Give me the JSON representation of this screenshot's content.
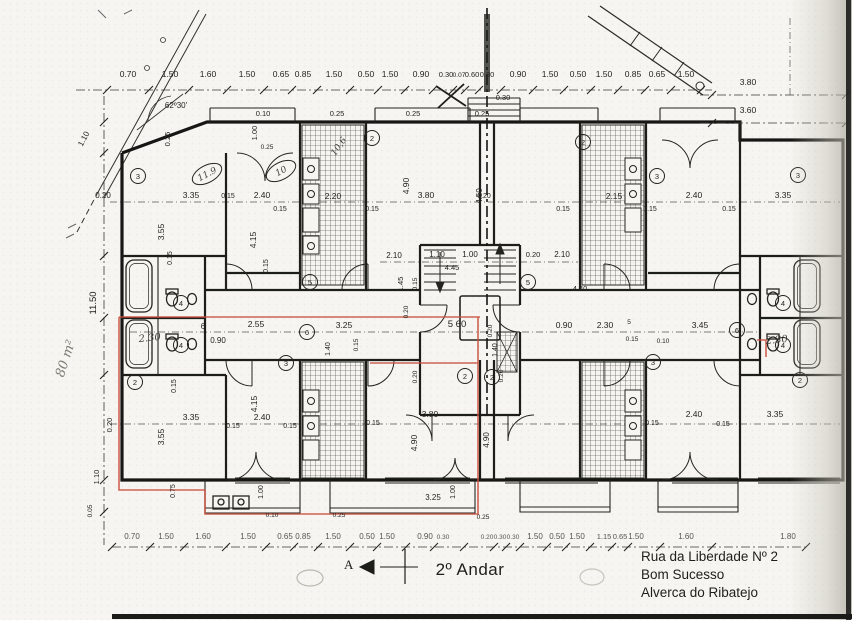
{
  "meta": {
    "title": "2º Andar"
  },
  "address": {
    "line1": "Rua da Liberdade Nº 2",
    "line2": "Bom Sucesso",
    "line3": "Alverca do Ribatejo"
  },
  "annotations": {
    "area_note": "80 m²",
    "section_letter": "A"
  },
  "colors": {
    "ink": "#24241f",
    "wall": "#161614",
    "highlight": "#c94f3d",
    "pencil": "#7b7b72",
    "paper": "#f6f5f1"
  },
  "plan": {
    "labels": [
      {
        "t": "0.70",
        "x": 128,
        "y": 77
      },
      {
        "t": "1.50",
        "x": 170,
        "y": 77
      },
      {
        "t": "1.60",
        "x": 208,
        "y": 77
      },
      {
        "t": "1.50",
        "x": 247,
        "y": 77
      },
      {
        "t": "0.65",
        "x": 281,
        "y": 77
      },
      {
        "t": "0.85",
        "x": 303,
        "y": 77
      },
      {
        "t": "1.50",
        "x": 334,
        "y": 77
      },
      {
        "t": "0.50",
        "x": 366,
        "y": 77
      },
      {
        "t": "1.50",
        "x": 390,
        "y": 77
      },
      {
        "t": "0.90",
        "x": 421,
        "y": 77
      },
      {
        "t": "0.30",
        "x": 446,
        "y": 77,
        "s": 7.5
      },
      {
        "t": "0.07",
        "x": 459,
        "y": 77,
        "s": 6.5
      },
      {
        "t": "0.60",
        "x": 472,
        "y": 77,
        "s": 7.5
      },
      {
        "t": "0.30",
        "x": 487,
        "y": 77,
        "s": 7.5
      },
      {
        "t": "0.90",
        "x": 518,
        "y": 77
      },
      {
        "t": "1.50",
        "x": 550,
        "y": 77
      },
      {
        "t": "0.50",
        "x": 578,
        "y": 77
      },
      {
        "t": "1.50",
        "x": 604,
        "y": 77
      },
      {
        "t": "0.85",
        "x": 633,
        "y": 77
      },
      {
        "t": "0.65",
        "x": 657,
        "y": 77
      },
      {
        "t": "1.50",
        "x": 686,
        "y": 77
      },
      {
        "t": "0.30",
        "x": 503,
        "y": 100,
        "s": 7.5
      },
      {
        "t": "3.80",
        "x": 748,
        "y": 85
      },
      {
        "t": "3.60",
        "x": 748,
        "y": 113
      },
      {
        "t": "0.70",
        "x": 132,
        "y": 539,
        "k": "dim2",
        "s": 8
      },
      {
        "t": "1.50",
        "x": 166,
        "y": 539,
        "k": "dim2",
        "s": 8
      },
      {
        "t": "1.60",
        "x": 203,
        "y": 539,
        "k": "dim2",
        "s": 8
      },
      {
        "t": "1.50",
        "x": 248,
        "y": 539,
        "k": "dim2",
        "s": 8
      },
      {
        "t": "0.65",
        "x": 285,
        "y": 539,
        "k": "dim2",
        "s": 8
      },
      {
        "t": "0.85",
        "x": 303,
        "y": 539,
        "k": "dim2",
        "s": 8
      },
      {
        "t": "1.50",
        "x": 333,
        "y": 539,
        "k": "dim2",
        "s": 8
      },
      {
        "t": "0.50",
        "x": 367,
        "y": 539,
        "k": "dim2",
        "s": 8
      },
      {
        "t": "1.50",
        "x": 387,
        "y": 539,
        "k": "dim2",
        "s": 8
      },
      {
        "t": "0.90",
        "x": 425,
        "y": 539,
        "k": "dim2",
        "s": 8
      },
      {
        "t": "0.30",
        "x": 443,
        "y": 539,
        "k": "dim2",
        "s": 6.5
      },
      {
        "t": "0.20",
        "x": 487,
        "y": 539,
        "k": "dim2",
        "s": 6.5
      },
      {
        "t": "0.30",
        "x": 500,
        "y": 539,
        "k": "dim2",
        "s": 6.5
      },
      {
        "t": "0.30",
        "x": 513,
        "y": 539,
        "k": "dim2",
        "s": 6.5
      },
      {
        "t": "1.50",
        "x": 535,
        "y": 539,
        "k": "dim2",
        "s": 8
      },
      {
        "t": "0.50",
        "x": 557,
        "y": 539,
        "k": "dim2",
        "s": 8
      },
      {
        "t": "1.50",
        "x": 577,
        "y": 539,
        "k": "dim2",
        "s": 8
      },
      {
        "t": "1.15",
        "x": 604,
        "y": 539,
        "k": "dim2",
        "s": 7.5
      },
      {
        "t": "0.65",
        "x": 620,
        "y": 539,
        "k": "dim2",
        "s": 7.5
      },
      {
        "t": "1.50",
        "x": 636,
        "y": 539,
        "k": "dim2",
        "s": 8
      },
      {
        "t": "1.60",
        "x": 686,
        "y": 539,
        "k": "dim2",
        "s": 8
      },
      {
        "t": "1.80",
        "x": 788,
        "y": 539,
        "k": "dim2",
        "s": 8
      },
      {
        "t": "1.10",
        "x": 86,
        "y": 140,
        "r": -62,
        "s": 8
      },
      {
        "t": "11.50",
        "x": 96,
        "y": 303,
        "r": -90,
        "s": 9.5
      },
      {
        "t": "1.10",
        "x": 99,
        "y": 477,
        "r": -90,
        "s": 7.5
      },
      {
        "t": "0.05",
        "x": 92,
        "y": 511,
        "r": -90,
        "s": 6.5
      },
      {
        "t": "0.20",
        "x": 103,
        "y": 198,
        "s": 8
      },
      {
        "t": "3.35",
        "x": 191,
        "y": 198
      },
      {
        "t": "0.15",
        "x": 228,
        "y": 198,
        "s": 7
      },
      {
        "t": "2.40",
        "x": 262,
        "y": 198
      },
      {
        "t": "0.15",
        "x": 280,
        "y": 211,
        "s": 7
      },
      {
        "t": "2.20",
        "x": 333,
        "y": 199
      },
      {
        "t": "0.15",
        "x": 372,
        "y": 211,
        "s": 7
      },
      {
        "t": "3.80",
        "x": 426,
        "y": 198
      },
      {
        "t": "0.20",
        "x": 484,
        "y": 198,
        "s": 7
      },
      {
        "t": "0.15",
        "x": 563,
        "y": 211,
        "s": 7
      },
      {
        "t": "2.15",
        "x": 614,
        "y": 199
      },
      {
        "t": "0.15",
        "x": 650,
        "y": 211,
        "s": 7
      },
      {
        "t": "2.40",
        "x": 694,
        "y": 198
      },
      {
        "t": "0.15",
        "x": 729,
        "y": 211,
        "s": 7
      },
      {
        "t": "3.35",
        "x": 783,
        "y": 198
      },
      {
        "t": "3.55",
        "x": 164,
        "y": 232,
        "r": -90
      },
      {
        "t": "4.15",
        "x": 256,
        "y": 240,
        "r": -90
      },
      {
        "t": "4.90",
        "x": 409,
        "y": 186,
        "r": -90
      },
      {
        "t": "4.50",
        "x": 482,
        "y": 196,
        "r": -90,
        "s": 8
      },
      {
        "t": "0.15",
        "x": 172,
        "y": 258,
        "r": -90,
        "s": 7
      },
      {
        "t": "0.15",
        "x": 268,
        "y": 266,
        "r": -90,
        "s": 7
      },
      {
        "t": "0.25",
        "x": 170,
        "y": 139,
        "r": -90,
        "s": 7.5
      },
      {
        "t": "1.00",
        "x": 257,
        "y": 133,
        "r": -90,
        "s": 7.5
      },
      {
        "t": "0.10",
        "x": 263,
        "y": 116,
        "s": 7.5
      },
      {
        "t": "0.25",
        "x": 337,
        "y": 116,
        "s": 7.5
      },
      {
        "t": "0.25",
        "x": 413,
        "y": 116,
        "s": 7.5
      },
      {
        "t": "0.25",
        "x": 482,
        "y": 116,
        "s": 7.5
      },
      {
        "t": "0.25",
        "x": 267,
        "y": 149,
        "s": 6.5
      },
      {
        "t": "62º30'",
        "x": 176,
        "y": 108,
        "s": 8
      },
      {
        "t": "2.10",
        "x": 394,
        "y": 258,
        "s": 8
      },
      {
        "t": "1.10",
        "x": 437,
        "y": 257,
        "s": 8
      },
      {
        "t": "1.00",
        "x": 470,
        "y": 257,
        "s": 8
      },
      {
        "t": "0.20",
        "x": 533,
        "y": 257,
        "s": 7.5
      },
      {
        "t": "2.10",
        "x": 562,
        "y": 257,
        "s": 8
      },
      {
        "t": "1.45",
        "x": 403,
        "y": 284,
        "r": -90,
        "s": 7.5
      },
      {
        "t": "0.15",
        "x": 417,
        "y": 284,
        "r": -90,
        "s": 6.5
      },
      {
        "t": "0.20",
        "x": 408,
        "y": 312,
        "r": -90,
        "s": 6.5
      },
      {
        "t": "4.45",
        "x": 452,
        "y": 270,
        "s": 7.5
      },
      {
        "t": "4.40",
        "x": 580,
        "y": 291,
        "s": 7.5
      },
      {
        "t": "6",
        "x": 203,
        "y": 329,
        "s": 8
      },
      {
        "t": "2.55",
        "x": 256,
        "y": 327
      },
      {
        "t": "0.90",
        "x": 218,
        "y": 343,
        "s": 8
      },
      {
        "t": "3.25",
        "x": 344,
        "y": 328
      },
      {
        "t": "1.40",
        "x": 330,
        "y": 349,
        "r": -90,
        "s": 7
      },
      {
        "t": "0.15",
        "x": 358,
        "y": 345,
        "r": -90,
        "s": 6.5
      },
      {
        "t": "5 60",
        "x": 457,
        "y": 327,
        "s": 9.5
      },
      {
        "t": "1.40",
        "x": 497,
        "y": 350,
        "r": -90,
        "s": 7
      },
      {
        "t": "0.20",
        "x": 492,
        "y": 331,
        "r": -90,
        "s": 6.5
      },
      {
        "t": "0.90",
        "x": 564,
        "y": 328
      },
      {
        "t": "2.30",
        "x": 605,
        "y": 328
      },
      {
        "t": "5",
        "x": 629,
        "y": 324,
        "s": 6.5
      },
      {
        "t": "0.15",
        "x": 632,
        "y": 341,
        "s": 6.5
      },
      {
        "t": "3.45",
        "x": 700,
        "y": 328
      },
      {
        "t": "0.10",
        "x": 663,
        "y": 343,
        "s": 6.5
      },
      {
        "t": "2.30",
        "x": 150,
        "y": 341,
        "k": "hand",
        "s": 10,
        "r": -6
      },
      {
        "t": "2.30",
        "x": 777,
        "y": 343,
        "k": "hand",
        "s": 10,
        "r": -6
      },
      {
        "t": "3.35",
        "x": 191,
        "y": 420
      },
      {
        "t": "0.15",
        "x": 233,
        "y": 428,
        "s": 7
      },
      {
        "t": "2.40",
        "x": 262,
        "y": 420
      },
      {
        "t": "0.15",
        "x": 290,
        "y": 428,
        "s": 7
      },
      {
        "t": "3.80",
        "x": 430,
        "y": 417
      },
      {
        "t": "0.15",
        "x": 373,
        "y": 425,
        "s": 7
      },
      {
        "t": "2.40",
        "x": 694,
        "y": 417
      },
      {
        "t": "0.15",
        "x": 652,
        "y": 425,
        "s": 7
      },
      {
        "t": "3.35",
        "x": 775,
        "y": 417
      },
      {
        "t": "0.15",
        "x": 723,
        "y": 426,
        "s": 7
      },
      {
        "t": "3.55",
        "x": 164,
        "y": 437,
        "r": -90
      },
      {
        "t": "4.15",
        "x": 257,
        "y": 404,
        "r": -90
      },
      {
        "t": "0.15",
        "x": 176,
        "y": 386,
        "r": -90,
        "s": 7
      },
      {
        "t": "4.90",
        "x": 417,
        "y": 443,
        "r": -90
      },
      {
        "t": "0.20",
        "x": 417,
        "y": 377,
        "r": -90,
        "s": 6.5
      },
      {
        "t": "4.90",
        "x": 489,
        "y": 440,
        "r": -90,
        "s": 8
      },
      {
        "t": "0.20",
        "x": 503,
        "y": 376,
        "r": -90,
        "s": 6.5
      },
      {
        "t": "0.20",
        "x": 112,
        "y": 425,
        "r": -90,
        "s": 7.5
      },
      {
        "t": "0.75",
        "x": 175,
        "y": 491,
        "r": -90,
        "s": 7
      },
      {
        "t": "1.00",
        "x": 263,
        "y": 492,
        "r": -90,
        "s": 7
      },
      {
        "t": "1.00",
        "x": 455,
        "y": 492,
        "r": -90,
        "s": 7
      },
      {
        "t": "3.25",
        "x": 433,
        "y": 500,
        "s": 8
      },
      {
        "t": "0.10",
        "x": 272,
        "y": 517,
        "s": 6.5
      },
      {
        "t": "0.25",
        "x": 339,
        "y": 517,
        "s": 6.5
      },
      {
        "t": "0.25",
        "x": 483,
        "y": 519,
        "s": 6.5
      },
      {
        "t": "10,6",
        "x": 341,
        "y": 148,
        "k": "hand",
        "s": 9,
        "r": -55
      }
    ],
    "ovals": [
      {
        "t": "11.9",
        "x": 207,
        "y": 174,
        "r": -28
      },
      {
        "t": "10",
        "x": 281,
        "y": 171,
        "r": -28
      }
    ],
    "circles": [
      {
        "n": "3",
        "x": 138,
        "y": 176
      },
      {
        "n": "2",
        "x": 372,
        "y": 138
      },
      {
        "n": "2",
        "x": 583,
        "y": 142
      },
      {
        "n": "3",
        "x": 657,
        "y": 176
      },
      {
        "n": "3",
        "x": 798,
        "y": 175
      },
      {
        "n": "5",
        "x": 310,
        "y": 282
      },
      {
        "n": "5",
        "x": 528,
        "y": 282
      },
      {
        "n": "6",
        "x": 307,
        "y": 332
      },
      {
        "n": "6",
        "x": 737,
        "y": 330
      },
      {
        "n": "3",
        "x": 286,
        "y": 363
      },
      {
        "n": "3",
        "x": 653,
        "y": 362
      },
      {
        "n": "2",
        "x": 135,
        "y": 382
      },
      {
        "n": "2",
        "x": 465,
        "y": 376
      },
      {
        "n": "2",
        "x": 492,
        "y": 377
      },
      {
        "n": "2",
        "x": 800,
        "y": 380
      },
      {
        "n": "4",
        "x": 181,
        "y": 303
      },
      {
        "n": "4",
        "x": 181,
        "y": 345
      },
      {
        "n": "4",
        "x": 783,
        "y": 303
      },
      {
        "n": "4",
        "x": 783,
        "y": 345
      }
    ],
    "chains": [
      {
        "o": "h",
        "y": 90,
        "x1": 76,
        "x2": 712,
        "ticks": [
          107,
          149,
          189,
          227,
          264,
          292,
          317,
          350,
          378,
          405,
          433,
          453,
          465,
          479,
          501,
          533,
          564,
          591,
          618,
          645,
          671,
          701
        ]
      },
      {
        "o": "h",
        "y": 547,
        "x1": 112,
        "x2": 806,
        "ticks": [
          112,
          150,
          184,
          226,
          266,
          294,
          318,
          350,
          377,
          406,
          434,
          464,
          494,
          506,
          520,
          547,
          566,
          590,
          612,
          628,
          660,
          712,
          806
        ]
      },
      {
        "o": "v",
        "x": 104,
        "y1": 96,
        "y2": 545,
        "ticks": [
          122,
          153,
          256,
          318,
          375,
          480,
          512
        ]
      },
      {
        "o": "h",
        "y": 95,
        "x1": 700,
        "x2": 846,
        "ticks": [
          712,
          846
        ]
      },
      {
        "o": "h",
        "y": 123,
        "x1": 700,
        "x2": 846,
        "ticks": [
          712,
          846
        ]
      }
    ]
  }
}
